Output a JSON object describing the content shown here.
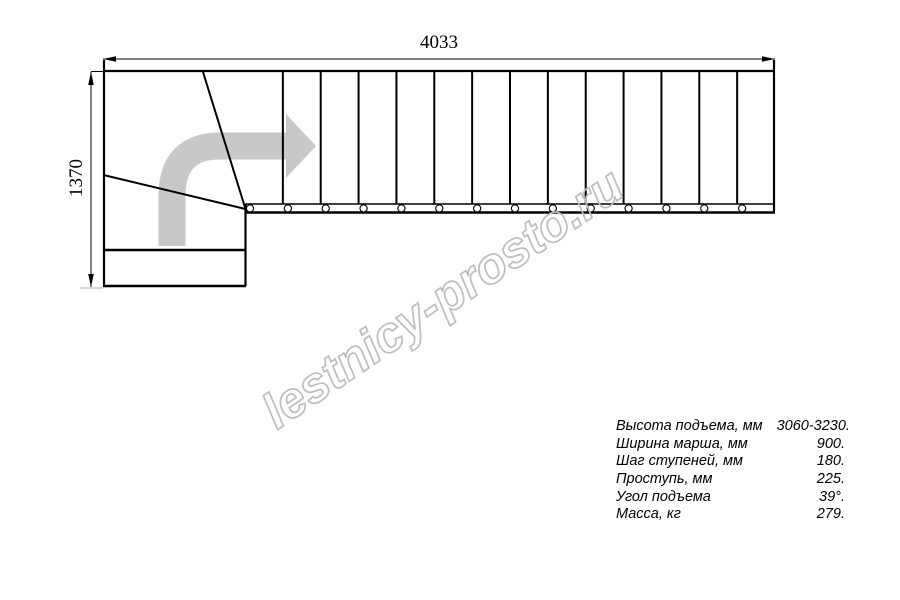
{
  "drawing": {
    "width_label": "4033",
    "height_label": "1370",
    "watermark": "lestnicy-prosto.ru"
  },
  "stair": {
    "straight_flight_treads": 14,
    "stringer_bolts": 14,
    "winder_diagonal_treads": 2,
    "lower_steps": 2
  },
  "specs": {
    "rows": [
      {
        "label": "Высота подъема, мм",
        "value": "3060-3230."
      },
      {
        "label": "Ширина марша, мм",
        "value": "900."
      },
      {
        "label": "Шаг ступеней, мм",
        "value": "180."
      },
      {
        "label": "Проступь, мм",
        "value": "225."
      },
      {
        "label": "Угол подъема",
        "value": "39°."
      },
      {
        "label": "Масса, кг",
        "value": "279."
      }
    ]
  },
  "colors": {
    "line": "#000000",
    "direction_arrow": "#c8c8c8",
    "watermark": "#bdbdbd",
    "background": "#ffffff"
  }
}
